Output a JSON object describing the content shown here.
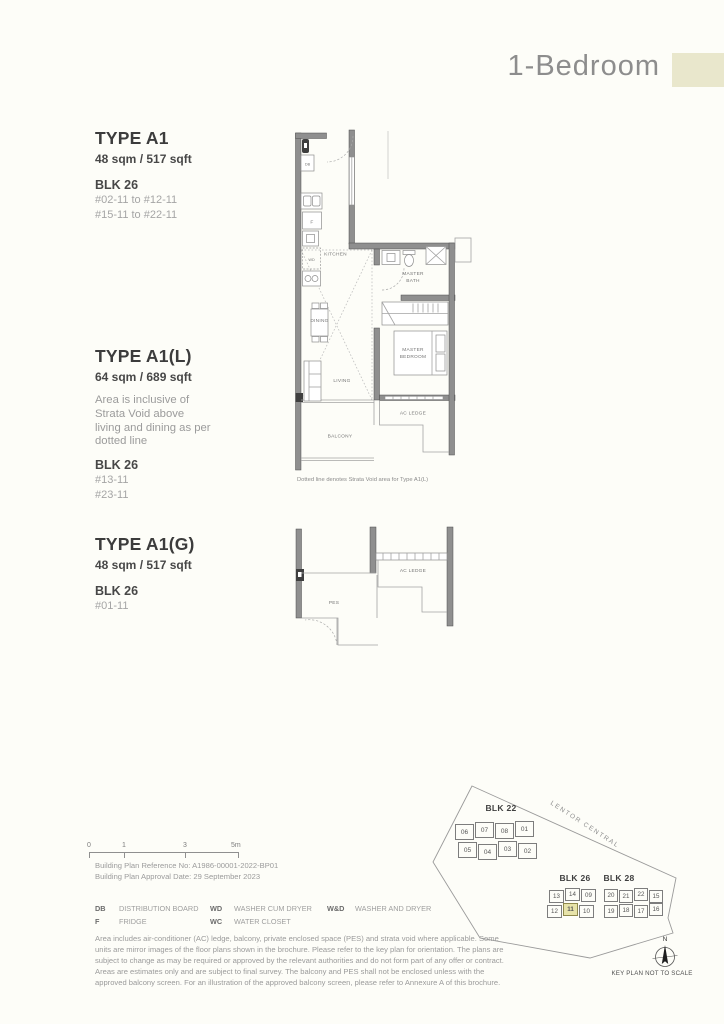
{
  "header": {
    "title": "1-Bedroom"
  },
  "colors": {
    "accent_swatch": "#e9e7cc"
  },
  "types": [
    {
      "name": "TYPE A1",
      "area": "48 sqm / 517 sqft",
      "note": "",
      "block": "BLK 26",
      "units": [
        "#02-11 to #12-11",
        "#15-11 to #22-11"
      ]
    },
    {
      "name": "TYPE A1(L)",
      "area": "64 sqm / 689 sqft",
      "note": "Area is inclusive of Strata Void above living and dining as per dotted line",
      "block": "BLK 26",
      "units": [
        "#13-11",
        "#23-11"
      ]
    },
    {
      "name": "TYPE A1(G)",
      "area": "48 sqm / 517 sqft",
      "note": "",
      "block": "BLK 26",
      "units": [
        "#01-11"
      ]
    }
  ],
  "plan_main": {
    "labels": {
      "db": "DB",
      "f": "F",
      "wd": "WD",
      "kitchen": "KITCHEN",
      "master_bath_1": "MASTER",
      "master_bath_2": "BATH",
      "dining": "DINING",
      "living": "LIVING",
      "master_bedroom_1": "MASTER",
      "master_bedroom_2": "BEDROOM",
      "ac_ledge": "AC LEDGE",
      "balcony": "BALCONY"
    },
    "caption": "Dotted line denotes Strata Void area for Type A1(L)"
  },
  "plan_ground": {
    "labels": {
      "pes": "PES",
      "ac_ledge": "AC LEDGE"
    }
  },
  "scale_bar": {
    "ticks": [
      "0",
      "1",
      "3",
      "5m"
    ]
  },
  "building_plan": {
    "reference": "Building Plan Reference No: A1986-00001-2022-BP01",
    "approval": "Building Plan Approval Date: 29 September 2023"
  },
  "legend": [
    {
      "abbr": "DB",
      "label": "DISTRIBUTION BOARD"
    },
    {
      "abbr": "F",
      "label": "FRIDGE"
    },
    {
      "abbr": "WD",
      "label": "WASHER CUM DRYER"
    },
    {
      "abbr": "WC",
      "label": "WATER CLOSET"
    },
    {
      "abbr": "W&D",
      "label": "WASHER AND DRYER"
    }
  ],
  "disclaimer": "Area includes air-conditioner (AC) ledge, balcony, private enclosed space (PES) and strata void where applicable. Some units are mirror images of the floor plans shown in the brochure. Please refer to the key plan for orientation. The plans are subject to change as may be required or approved by the relevant authorities and do not form part of any offer or contract. Areas are estimates only and are subject to final survey. The balcony and PES shall not be enclosed unless with the approved balcony screen. For an illustration of the approved balcony screen, please refer to Annexure A of this brochure.",
  "key_plan": {
    "road": "LENTOR CENTRAL",
    "north_label": "N",
    "caption": "KEY PLAN NOT TO SCALE",
    "highlight_unit": "11",
    "highlight_color": "#e7e3a9",
    "blocks": [
      {
        "name": "BLK 22",
        "rows": [
          [
            "06",
            "07",
            "08",
            "01"
          ],
          [
            "05",
            "04",
            "03",
            "02"
          ]
        ]
      },
      {
        "name": "BLK 26",
        "rows": [
          [
            "13",
            "14",
            "09"
          ],
          [
            "12",
            "11",
            "10"
          ]
        ]
      },
      {
        "name": "BLK 28",
        "rows": [
          [
            "20",
            "21",
            "22",
            "15"
          ],
          [
            "19",
            "18",
            "17",
            "16"
          ]
        ]
      }
    ]
  }
}
